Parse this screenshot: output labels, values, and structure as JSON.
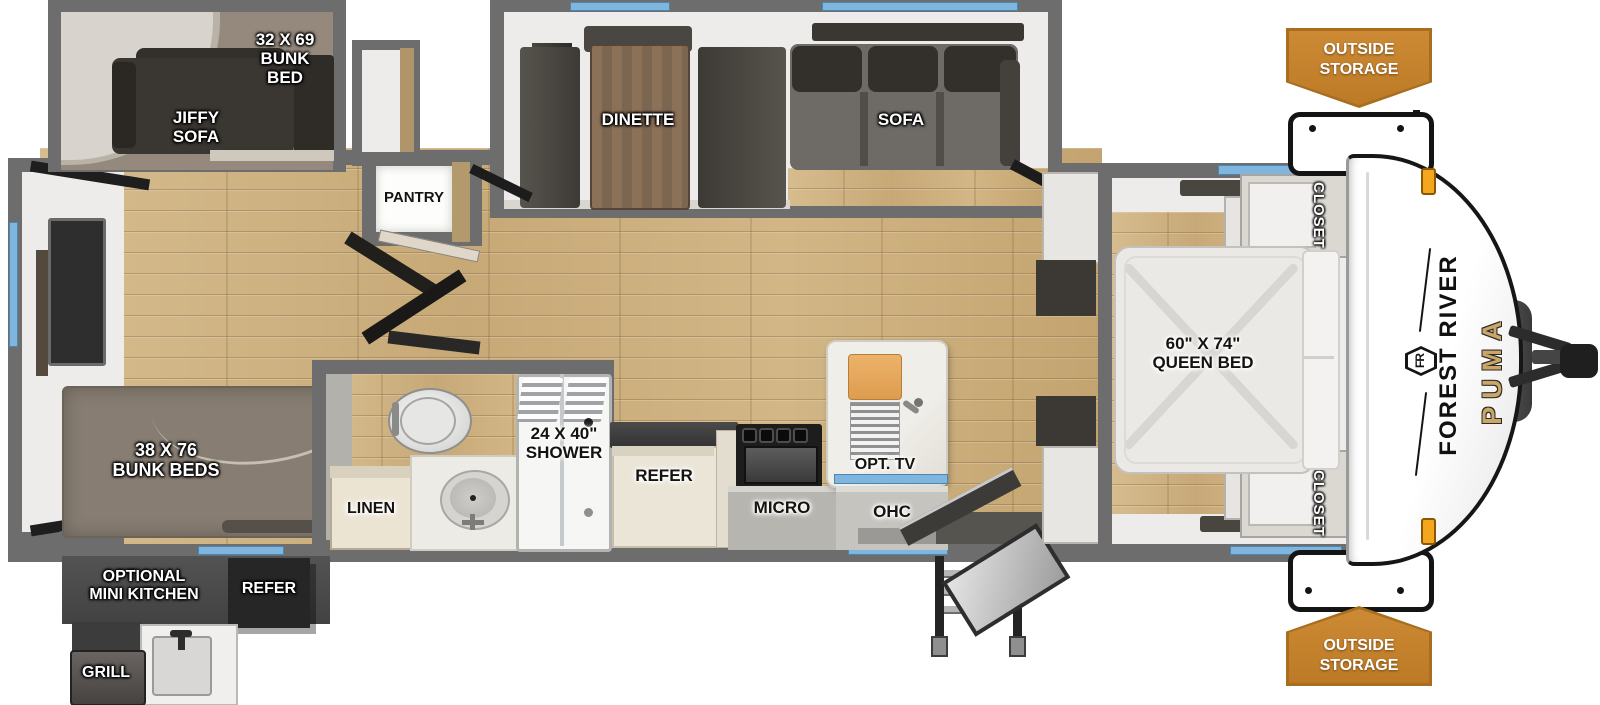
{
  "colors": {
    "wall_gray": "#6d6d6d",
    "window_blue": "#7fb6e0",
    "badge_orange": "#c5812f",
    "wood_floor": "#cdb183",
    "brand_gold": "#c9a76b"
  },
  "badges": {
    "top": {
      "line1": "OUTSIDE",
      "line2": "STORAGE"
    },
    "bottom": {
      "line1": "OUTSIDE",
      "line2": "STORAGE"
    }
  },
  "brand": {
    "maker": "FOREST RIVER",
    "model": "PUMA",
    "logo": "FR"
  },
  "rear_room": {
    "upper_bunk": {
      "line1": "32 X 69",
      "line2": "BUNK",
      "line3": "BED"
    },
    "jiffy_sofa": {
      "line1": "JIFFY",
      "line2": "SOFA"
    },
    "lower_bunks": {
      "line1": "38 X 76",
      "line2": "BUNK BEDS"
    }
  },
  "outdoor_kitchen": {
    "title": {
      "line1": "OPTIONAL",
      "line2": "MINI KITCHEN"
    },
    "refer": "REFER",
    "grill": "GRILL"
  },
  "living": {
    "pantry": "PANTRY",
    "dinette": "DINETTE",
    "sofa": "SOFA"
  },
  "bath": {
    "linen": "LINEN",
    "shower": {
      "line1": "24 X 40\"",
      "line2": "SHOWER"
    }
  },
  "kitchen": {
    "refer": "REFER",
    "micro": "MICRO",
    "ohc": "OHC",
    "opt_tv": "OPT. TV"
  },
  "bedroom": {
    "bed": {
      "line1": "60\" X 74\"",
      "line2": "QUEEN BED"
    },
    "closet_top": "CLOSET",
    "closet_bottom": "CLOSET"
  }
}
